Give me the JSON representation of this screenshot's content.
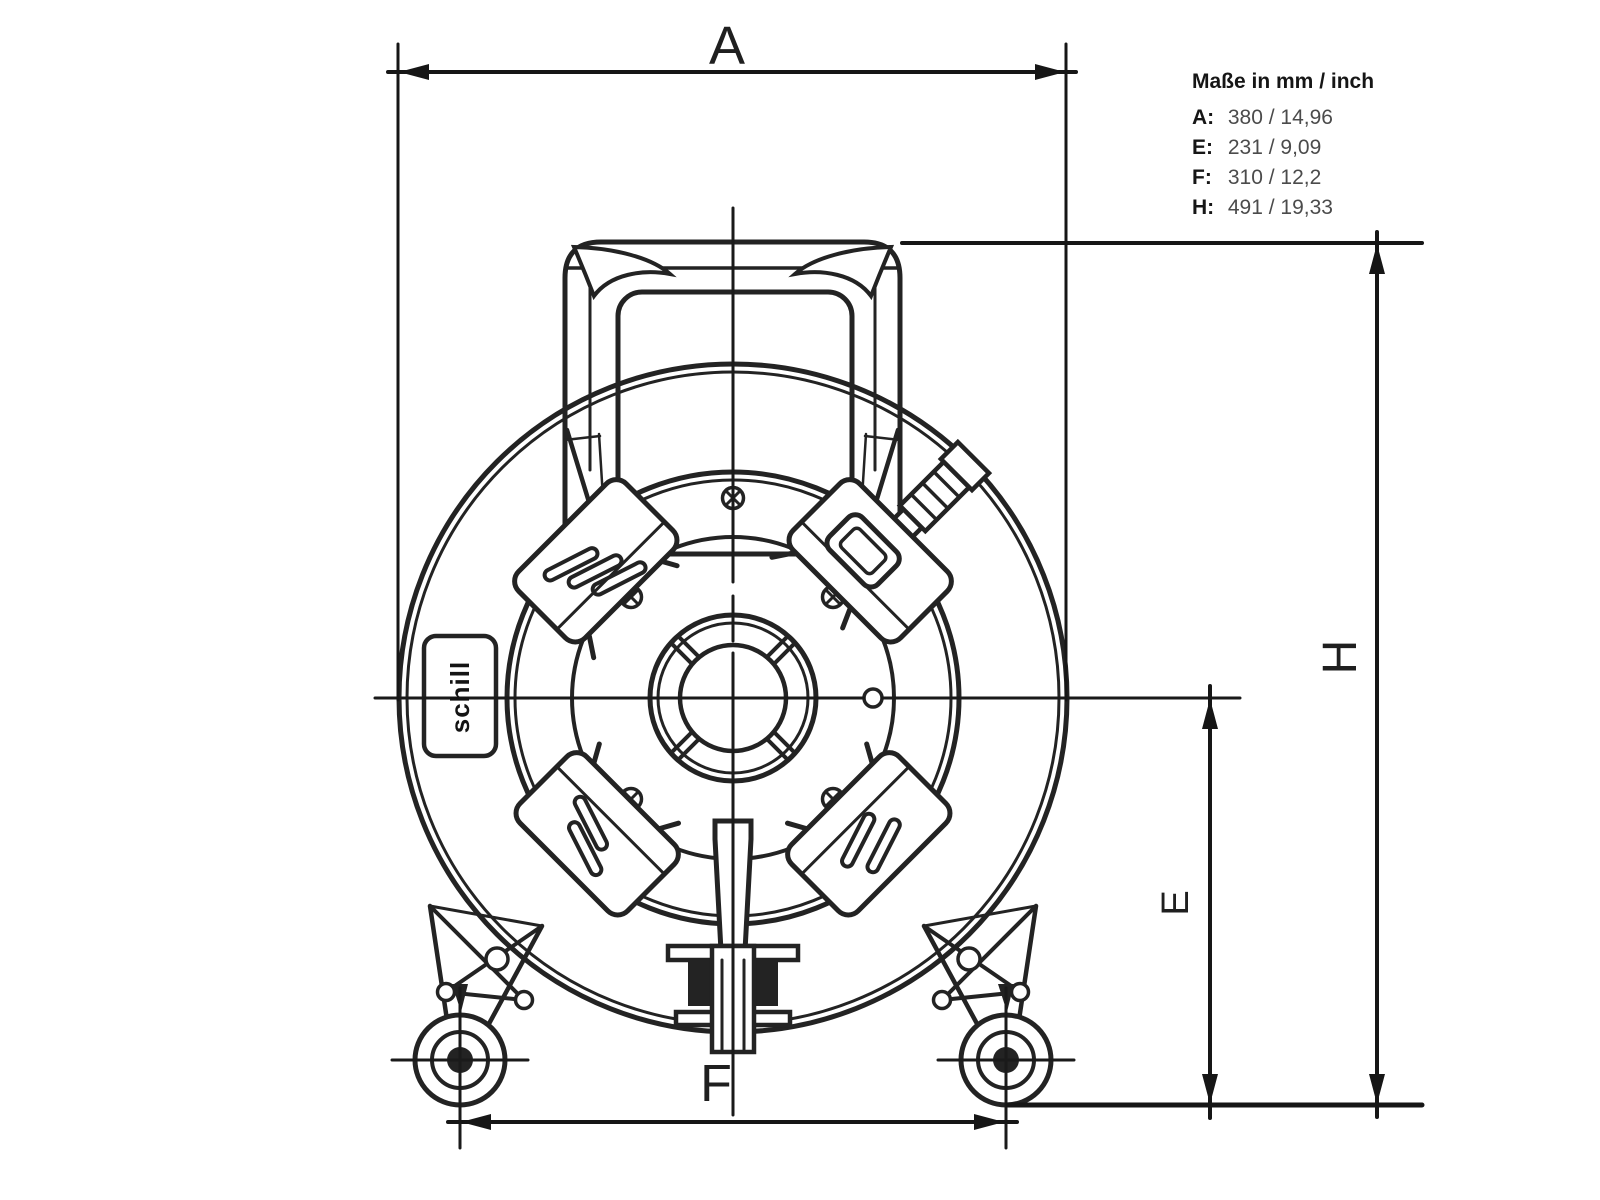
{
  "drawing": {
    "legend": {
      "title": "Maße in mm / inch",
      "rows": [
        {
          "label": "A:",
          "value": "380 / 14,96"
        },
        {
          "label": "E:",
          "value": "231 / 9,09"
        },
        {
          "label": "F:",
          "value": "310 / 12,2"
        },
        {
          "label": "H:",
          "value": "491 / 19,33"
        }
      ]
    },
    "dimension_labels": {
      "a": "A",
      "e": "E",
      "f": "F",
      "h": "H"
    },
    "logo_text": "schill",
    "colors": {
      "line": "#232323",
      "dimension_line": "#161616",
      "background": "#ffffff"
    }
  }
}
